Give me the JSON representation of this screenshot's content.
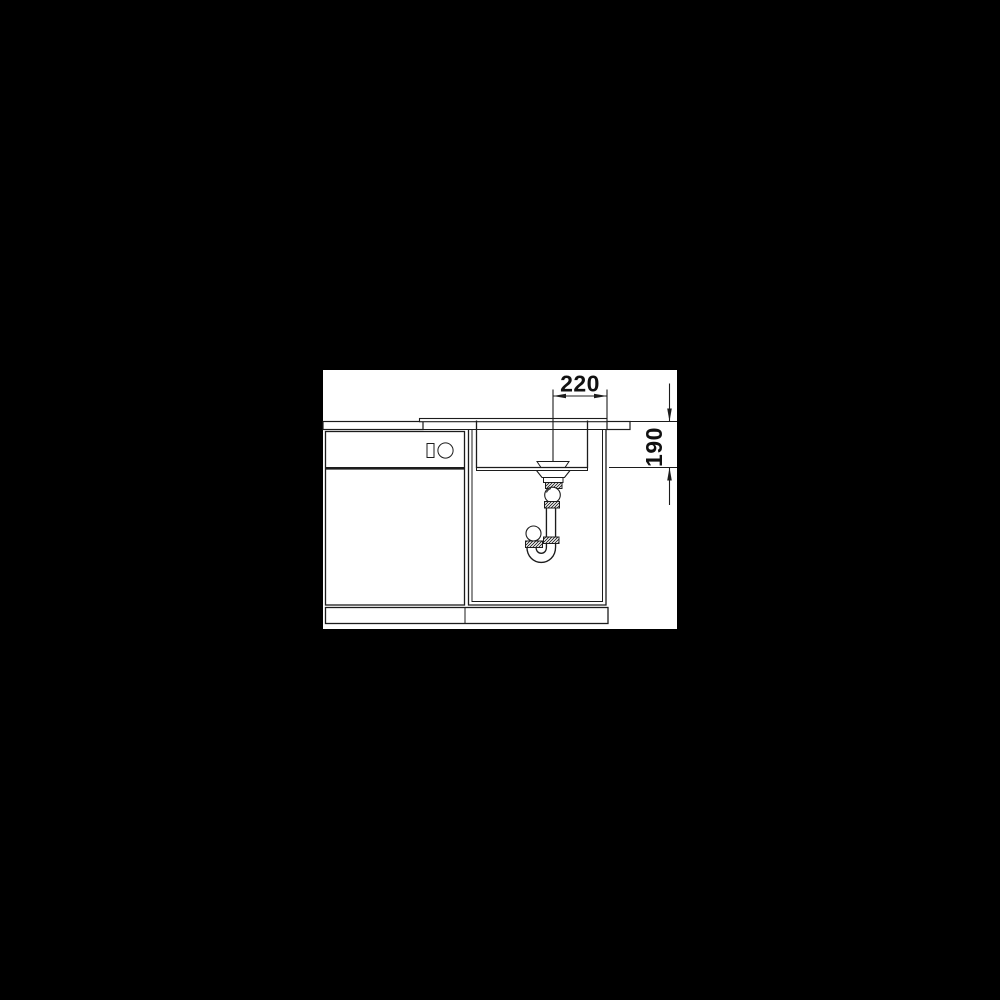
{
  "colors": {
    "page-bg": "#000000",
    "canvas-bg": "#ffffff",
    "line-color": "#1c1c1c",
    "text-color": "#111111"
  },
  "diagram": {
    "dimensions": {
      "drain_offset_label": "220",
      "bowl_depth_label": "190"
    }
  }
}
